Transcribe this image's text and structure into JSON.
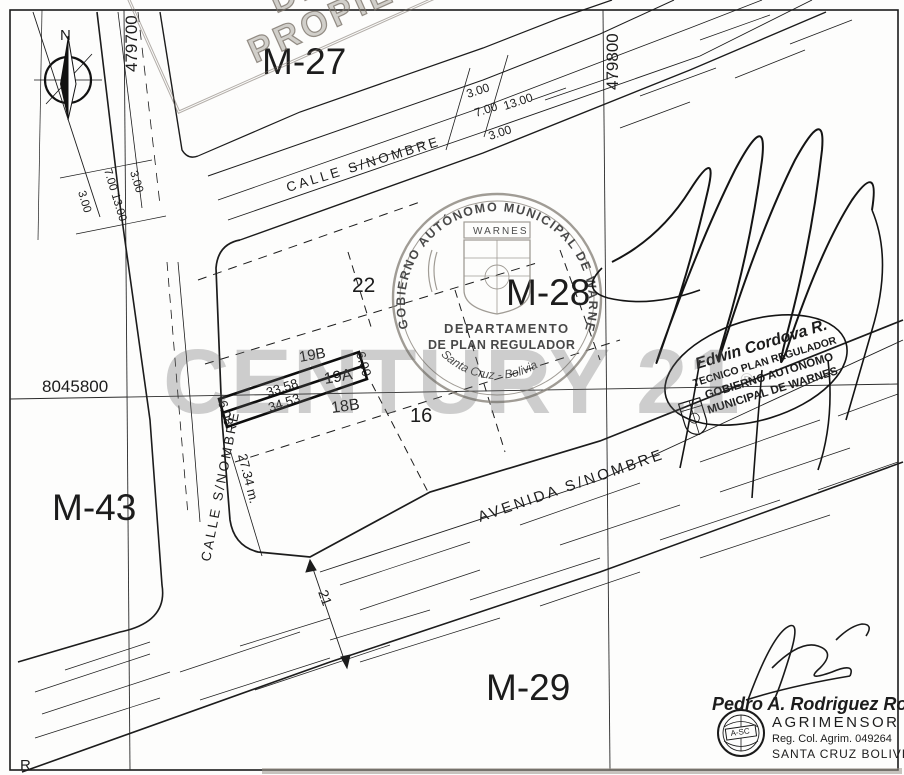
{
  "map": {
    "blocks": [
      {
        "label": "M-27"
      },
      {
        "label": "M-28"
      },
      {
        "label": "M-43"
      },
      {
        "label": "M-29"
      }
    ],
    "lots": [
      {
        "label": "22"
      },
      {
        "label": "19B"
      },
      {
        "label": "19A"
      },
      {
        "label": "18B"
      },
      {
        "label": "16"
      }
    ],
    "dimensions": {
      "front": "33.58",
      "back": "34.53",
      "side_right": "6.00",
      "side_left": "6.08",
      "corner_length": "27.34 m.",
      "avenue_width": "21"
    },
    "streets": {
      "top_street": "CALLE S/NOMBRE",
      "left_street": "CALLE S/NOMBRE",
      "avenue": "AVENIDA S/NOMBRE"
    },
    "sections": {
      "top": [
        "3.00",
        "7.00",
        "13.00",
        "3.00"
      ],
      "left": [
        "3.00",
        "7.00  13.00",
        "3.00"
      ]
    },
    "grid": {
      "v_left": "479700",
      "v_right": "479800",
      "h_mid": "8045800"
    },
    "compass_label": "N",
    "corner_letter": "R"
  },
  "stamps": {
    "warning": {
      "line1": "ESTE PLANO NO ACREDITA",
      "line2": "DERECHO PROPIETARIO"
    },
    "municipal": {
      "arc_top": "GOBIERNO AUTÓNOMO MUNICIPAL DE WARNES",
      "shield_banner": "WARNES",
      "dept_line1": "DEPARTAMENTO",
      "dept_line2": "DE PLAN REGULADOR",
      "arc_bottom": "Santa Cruz - Bolivia"
    },
    "regulator": {
      "name": "Edwin Cordova R.",
      "role": "TECNICO PLAN REGULADOR",
      "org_line1": "GOBIERNO AUTONOMO",
      "org_line2": "MUNICIPAL DE WARNES"
    },
    "surveyor": {
      "name": "Pedro A. Rodriguez Rojas",
      "title": "AGRIMENSOR",
      "registration": "Reg. Col. Agrim. 049264",
      "location": "SANTA CRUZ BOLIVIA",
      "logo_text": "A-SC"
    }
  },
  "watermark": {
    "text": "CENTURY 21",
    "reg": "®"
  }
}
